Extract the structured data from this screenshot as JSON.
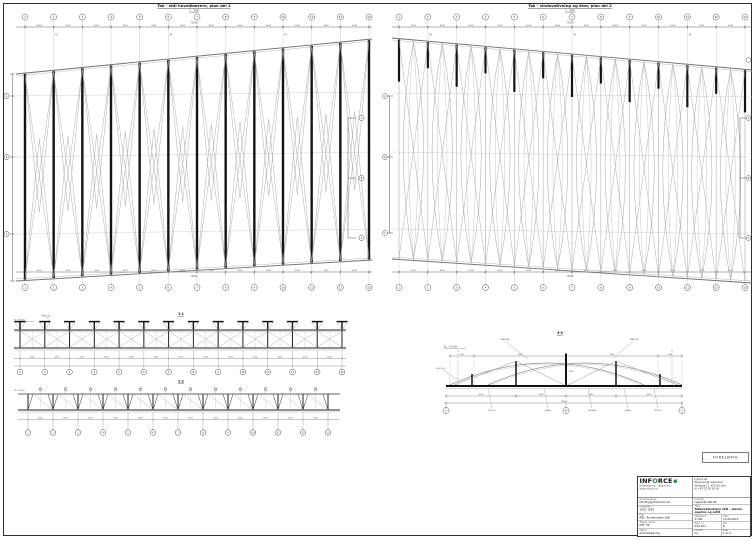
{
  "sheet": {
    "bg": "#ffffff",
    "border_color": "#2e2e2e"
  },
  "colors": {
    "ink": "#141414",
    "chord": "#6f6f6f",
    "brace": "#a6a6a6",
    "light": "#c4c4c4",
    "dim": "#555555",
    "green": "#17923f"
  },
  "plan_left": {
    "title": "Tak - stål hovedbærere, plan del 1",
    "subtitle": "1 : 100",
    "grid_labels": [
      "1",
      "2",
      "3",
      "4",
      "5",
      "6",
      "7",
      "8",
      "9",
      "10",
      "11",
      "12",
      "13"
    ],
    "bay_dim": "6000",
    "overall_dim": "72000",
    "side_labels": [
      "A",
      "B",
      "C"
    ],
    "marks": [
      "P1",
      "P1",
      "P1"
    ]
  },
  "plan_right": {
    "title": "Tak - vindavstivning og åser, plan del 2",
    "subtitle": "1 : 100",
    "grid_labels": [
      "1",
      "2",
      "3",
      "4",
      "5",
      "6",
      "7",
      "8",
      "9",
      "10",
      "11",
      "12",
      "13"
    ],
    "bay_dim": "6000",
    "overall_dim": "72000",
    "side_labels": [
      "A",
      "B",
      "C"
    ],
    "marks": [
      "P2",
      "P2",
      "P2"
    ]
  },
  "elev_a": {
    "label": "1-1",
    "elev_text": "EL +8.000",
    "callout": "HE120A",
    "bay_dim": "6000",
    "grid_labels": [
      "1",
      "2",
      "3",
      "4",
      "5",
      "6",
      "7",
      "8",
      "9",
      "10",
      "11",
      "12",
      "13",
      "14"
    ]
  },
  "elev_b": {
    "label": "2-2",
    "elev_text": "EL +8.000",
    "mark": "S1",
    "bay_dim": "6000",
    "grid_labels": [
      "1",
      "2",
      "3",
      "4",
      "5",
      "6",
      "7",
      "8",
      "9",
      "10",
      "11",
      "12",
      "13"
    ]
  },
  "section": {
    "label": "3-3",
    "elev_text": "EL. +10.800",
    "top_dims": [
      "600",
      "3600",
      "3600",
      "600"
    ],
    "bot_dims": [
      "4500",
      "3000",
      "3000",
      "4500"
    ],
    "overall_dim": "18000",
    "height_dim": "1500",
    "grid_labels": [
      "A",
      "B",
      "C"
    ],
    "callouts_top": [
      "Ø88.9x4",
      "Ø88.9x4"
    ],
    "callout_left": "HSQ 120",
    "callouts_bottom": [
      "IPE 270",
      "Ø48.3",
      "HE140B",
      "Ø48.3",
      "IPE 270"
    ]
  },
  "stamp": {
    "text": "FORELØPIG"
  },
  "titleblock": {
    "logo": {
      "pre": "INF",
      "o": "O",
      "post": "RCE",
      "tagline": "prosjektering - rådgivning",
      "sub": "www.inforce.no"
    },
    "left_rows": [
      {
        "label": "Oppdragsgiver",
        "value": "Nordbygg Eiendom AS"
      },
      {
        "label": "Prosjektnr.",
        "value": "2015-1042"
      },
      {
        "label": "Fag",
        "value": "RIB - Konstruksjon stål"
      },
      {
        "label": "Tegnet / Kontr.",
        "value": "MH / TK"
      },
      {
        "label": "Status",
        "value": "Arbeidstegning"
      }
    ],
    "address": [
      "Inforce AS",
      "Rådgivende ingeniører",
      "Storgata 12, N-0155 Oslo",
      "tlf +47 22 00 00 00"
    ],
    "project_row": {
      "label": "Prosjekt",
      "value": "Lagerhall felt B2"
    },
    "title_row": {
      "label": "Tittel",
      "value": "Takkonstruksjon stål - planer, oppriss og snitt"
    },
    "grid": [
      {
        "label": "Målestokk",
        "value": "1:100"
      },
      {
        "label": "Dato",
        "value": "12.06.2015"
      },
      {
        "label": "Tegn. nr.",
        "value": "K20-101"
      },
      {
        "label": "Rev.",
        "value": "B"
      },
      {
        "label": "Format",
        "value": "A1"
      },
      {
        "label": "Blad",
        "value": "1 av 1"
      }
    ]
  }
}
